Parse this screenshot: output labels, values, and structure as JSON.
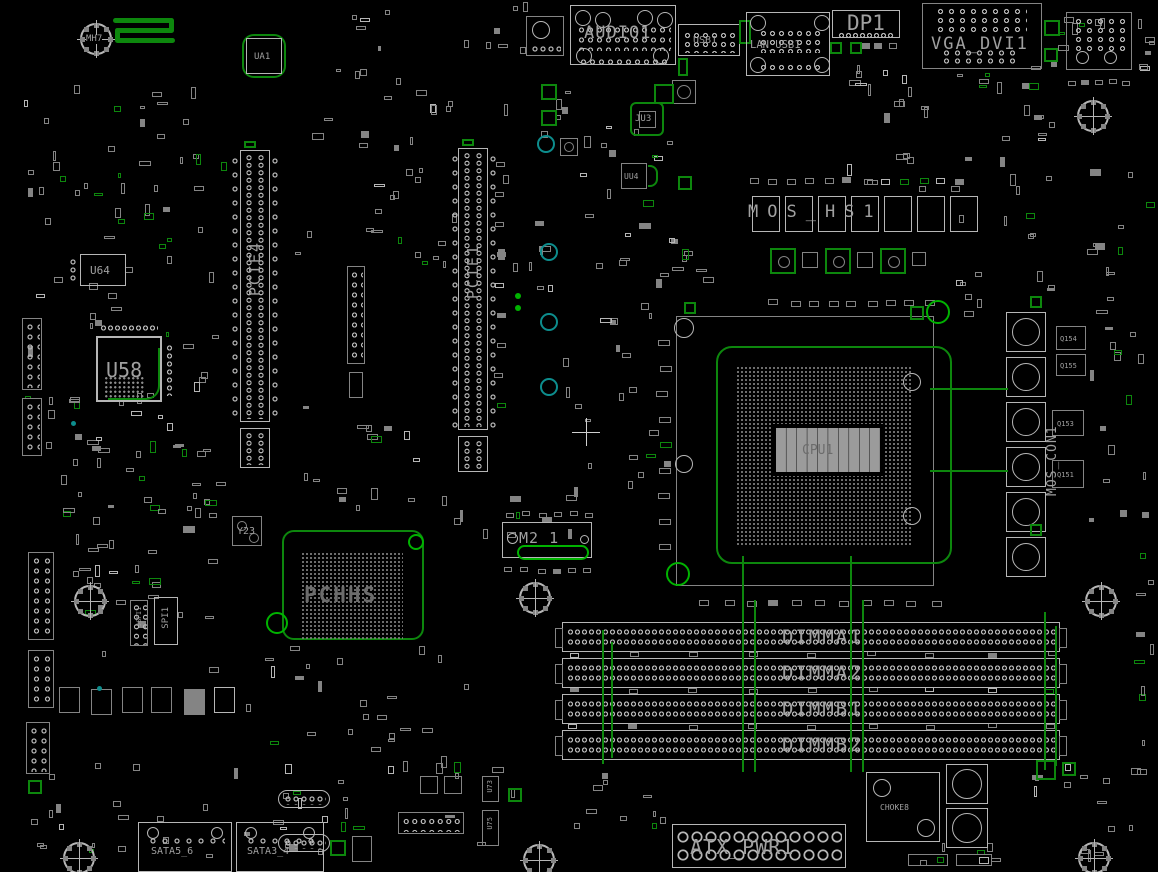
{
  "colors": {
    "bg": "#000000",
    "line": "#b6b6b6",
    "dim": "#848484",
    "pad": "#8d8d8d",
    "text": "#a0a0a0",
    "text_dim": "#6c6c6c",
    "green": "#0d870d",
    "green_bright": "#00b300",
    "teal": "#0d8d8d"
  },
  "labels": {
    "mh7": "MH7",
    "ua1": "UA1",
    "audio": "AUDIO1",
    "usb": "USB1",
    "lan_usb": "LAN_USB1",
    "dp": "DP1",
    "vga_dvi": "VGA_DVI1",
    "ju3": "JU3",
    "uu4": "UU4",
    "u64": "U64",
    "u58": "U58",
    "pcie4": "PCIE4",
    "pcie1": "PCIE1",
    "y23": "Y23",
    "jspi": "JSPI1",
    "spi": "SPI1",
    "pch": "PCHHS",
    "m2": "M2_1",
    "cpu": "CPU1",
    "mos_hs": "MOS_HS1",
    "mos_con": "MOS_CON1",
    "q154": "Q154",
    "q155": "Q155",
    "q153": "Q153",
    "q151": "Q151",
    "dimma1": "DIMMA1",
    "dimma2": "DIMMA2",
    "dimmb1": "DIMMB1",
    "dimmb2": "DIMMB2",
    "atx": "ATX_PWR1",
    "choke8": "CHOKE8",
    "sata56": "SATA5_6",
    "sata34": "SATA3_4",
    "u73": "U73",
    "u75": "U75"
  }
}
